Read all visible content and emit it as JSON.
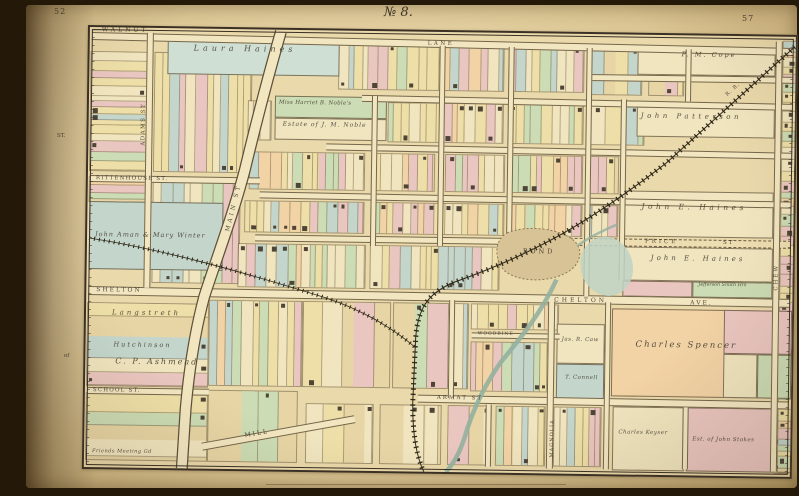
{
  "page": {
    "left_page_number": "52",
    "right_page_number": "57",
    "plate_title": "№ 8.",
    "margin_labels": [
      {
        "id": "margin-st",
        "text": "ST.",
        "x": 31,
        "y": 128
      },
      {
        "id": "margin-of",
        "text": "of",
        "x": 38,
        "y": 348
      }
    ]
  },
  "palette": {
    "paper": "#ead9ab",
    "street": "#f2e6c1",
    "line": "#6b5c41",
    "ink": "#3e362a",
    "pink": "#eac6c0",
    "green": "#ccdcb4",
    "teal": "#c4d6cc",
    "teal2": "#cfdfd4",
    "yellow": "#eedfa8",
    "cream": "#f0e5bf",
    "peach": "#f2d3a6",
    "building": "#4e4537",
    "pond": "#d8c396",
    "marsh": "#bfd3c4",
    "water": "#93b09f",
    "rail": "#2f2818"
  },
  "map": {
    "streets": [
      {
        "id": "walnut-lane-w",
        "band": [
          2,
          5,
          702,
          8
        ],
        "rot": 0.5,
        "labels": [
          {
            "text": "WALNUT",
            "x": 12,
            "y": 0,
            "size": 6,
            "sp": 3
          },
          {
            "text": "LANE",
            "x": 338,
            "y": 10,
            "size": 5.5,
            "sp": 2.5
          }
        ]
      },
      {
        "id": "street-upper-right",
        "band": [
          498,
          40,
          206,
          7
        ],
        "rot": 0,
        "labels": []
      },
      {
        "id": "street-haines-row",
        "band": [
          273,
          64,
          431,
          7
        ],
        "rot": 0.4,
        "labels": []
      },
      {
        "id": "street-mid-row",
        "band": [
          238,
          113,
          466,
          7
        ],
        "rot": 0.35,
        "labels": []
      },
      {
        "id": "rittenhouse-w",
        "band": [
          2,
          148,
          170,
          7
        ],
        "rot": 0,
        "labels": [
          {
            "text": "RITTENHOUSE  ST.",
            "x": 8,
            "y": 149,
            "size": 5.5,
            "sp": 1.2
          }
        ]
      },
      {
        "id": "rittenhouse-e",
        "band": [
          172,
          162,
          532,
          7
        ],
        "rot": 0.3,
        "labels": []
      },
      {
        "id": "street-row5-w",
        "band": [
          168,
          205,
          252,
          7
        ],
        "rot": 0,
        "labels": []
      },
      {
        "id": "price-st",
        "band": [
          418,
          204,
          286,
          8
        ],
        "rot": 0,
        "dashed": true,
        "labels": [
          {
            "text": "PRICE",
            "x": 558,
            "y": 205,
            "size": 5.5,
            "sp": 3
          },
          {
            "text": "ST",
            "x": 636,
            "y": 205,
            "size": 5.5,
            "sp": 2
          }
        ]
      },
      {
        "id": "shelton-chelton-ave",
        "band": [
          2,
          259,
          702,
          9
        ],
        "rot": 0.25,
        "labels": [
          {
            "text": "SHELTON",
            "x": 10,
            "y": 260,
            "size": 6,
            "sp": 2
          },
          {
            "text": "CHELTON",
            "x": 468,
            "y": 264,
            "size": 6,
            "sp": 3
          },
          {
            "text": "AVE.",
            "x": 604,
            "y": 265,
            "size": 6,
            "sp": 2
          }
        ]
      },
      {
        "id": "woodbine-st",
        "band": [
          386,
          300,
          88,
          6
        ],
        "rot": 0,
        "labels": [
          {
            "text": "WOODBINE",
            "x": 392,
            "y": 300,
            "size": 4.5,
            "sp": 1
          }
        ]
      },
      {
        "id": "school-st",
        "band": [
          2,
          360,
          122,
          7
        ],
        "rot": 0,
        "labels": [
          {
            "text": "SCHOOL  ST.",
            "x": 8,
            "y": 361,
            "size": 5.5,
            "sp": 1.2
          }
        ]
      },
      {
        "id": "armat-st",
        "band": [
          333,
          363,
          371,
          8
        ],
        "rot": 0.25,
        "labels": [
          {
            "text": "ARMAT  ST",
            "x": 352,
            "y": 364,
            "size": 5.5,
            "sp": 2
          }
        ]
      },
      {
        "id": "mill-st",
        "band": [
          118,
          414,
          155,
          8
        ],
        "rot": -11,
        "labels": [
          {
            "text": "MILL",
            "x": 160,
            "y": 404,
            "size": 6,
            "sp": 2,
            "rot": -11
          }
        ]
      },
      {
        "id": "adams-st",
        "band": [
          57,
          5,
          7,
          255
        ],
        "vertical": true,
        "labels": [
          {
            "text": "ADAMS  ST",
            "x": 53,
            "y": 118,
            "size": 5.5,
            "sp": 1.5,
            "rot": -90
          }
        ]
      },
      {
        "id": "magnolia-st",
        "band": [
          462,
          268,
          7,
          167
        ],
        "vertical": true,
        "labels": [
          {
            "text": "MAGNOLIA",
            "x": 466,
            "y": 424,
            "size": 5,
            "sp": 1,
            "rot": -90
          }
        ]
      },
      {
        "id": "chew-st",
        "band": [
          686,
          5,
          7,
          430
        ],
        "vertical": true,
        "labels": [
          {
            "text": "CHEW",
            "x": 688,
            "y": 254,
            "size": 5.5,
            "sp": 2,
            "rot": -90
          }
        ]
      },
      {
        "id": "vert-1",
        "band": [
          283,
          65,
          6,
          150
        ],
        "vertical": true,
        "labels": []
      },
      {
        "id": "vert-2",
        "band": [
          350,
          14,
          6,
          200
        ],
        "vertical": true,
        "labels": []
      },
      {
        "id": "vert-3",
        "band": [
          419,
          14,
          6,
          198
        ],
        "vertical": true,
        "labels": []
      },
      {
        "id": "vert-4",
        "band": [
          497,
          14,
          6,
          248
        ],
        "vertical": true,
        "labels": []
      },
      {
        "id": "vert-5",
        "band": [
          532,
          65,
          6,
          181
        ],
        "vertical": true,
        "labels": []
      },
      {
        "id": "vert-6",
        "band": [
          596,
          14,
          6,
          52
        ],
        "vertical": true,
        "labels": []
      },
      {
        "id": "vert-7",
        "band": [
          363,
          268,
          6,
          98
        ],
        "vertical": true,
        "labels": []
      },
      {
        "id": "vert-8",
        "band": [
          519,
          268,
          6,
          167
        ],
        "vertical": true,
        "labels": []
      },
      {
        "id": "vert-9",
        "band": [
          401,
          372,
          6,
          62
        ],
        "vertical": true,
        "labels": []
      },
      {
        "id": "vert-10",
        "band": [
          598,
          372,
          6,
          62
        ],
        "vertical": true,
        "labels": []
      }
    ],
    "feature_labels": [
      {
        "id": "main-st",
        "text": "MAIN  ST",
        "x": 138,
        "y": 202,
        "size": 6,
        "sp": 3,
        "rot": -77
      },
      {
        "id": "pond",
        "text": "POND",
        "x": 436,
        "y": 215,
        "size": 6.5,
        "sp": 3
      },
      {
        "id": "railroad",
        "text": "R. R.",
        "x": 636,
        "y": 58,
        "size": 5,
        "sp": 1,
        "rot": -43
      }
    ],
    "owner_labels": [
      {
        "id": "laura-haines",
        "text": "Laura Haines",
        "x": 104,
        "y": 16,
        "size": 8,
        "sp": 4
      },
      {
        "id": "noble-1",
        "text": "Miss Harriet B. Noble's",
        "x": 190,
        "y": 71,
        "size": 5.5,
        "sp": 0.3
      },
      {
        "id": "noble-2",
        "text": "Estate of J. M. Noble",
        "x": 194,
        "y": 92,
        "size": 6,
        "sp": 1
      },
      {
        "id": "cope",
        "text": "P. M. Cope",
        "x": 592,
        "y": 16,
        "size": 6.5,
        "sp": 2
      },
      {
        "id": "patterson",
        "text": "John Patterson",
        "x": 552,
        "y": 78,
        "size": 7,
        "sp": 3.5
      },
      {
        "id": "john-e-haines-1",
        "text": "John E. Haines",
        "x": 554,
        "y": 168,
        "size": 7.5,
        "sp": 3.5
      },
      {
        "id": "john-e-haines-2",
        "text": "John E. Haines",
        "x": 564,
        "y": 220,
        "size": 7,
        "sp": 3
      },
      {
        "id": "jefferson-smith",
        "text": "Jefferson Smith Hrs",
        "x": 612,
        "y": 248,
        "size": 4.8,
        "sp": 0
      },
      {
        "id": "charles-spencer",
        "text": "Charles Spencer",
        "x": 550,
        "y": 306,
        "size": 8.5,
        "sp": 2
      },
      {
        "id": "jas-caw",
        "text": "Jas. R. Caw",
        "x": 476,
        "y": 304,
        "size": 5.5,
        "sp": 0.5
      },
      {
        "id": "t-connell",
        "text": "T. Connell",
        "x": 480,
        "y": 342,
        "size": 5.5,
        "sp": 0.5
      },
      {
        "id": "langstreth",
        "text": "Langstreth",
        "x": 26,
        "y": 282,
        "size": 7,
        "sp": 3
      },
      {
        "id": "hutchinson",
        "text": "Hutchinson",
        "x": 28,
        "y": 314,
        "size": 6.5,
        "sp": 2
      },
      {
        "id": "ashmead",
        "text": "C. P. Ashmead",
        "x": 30,
        "y": 330,
        "size": 8,
        "sp": 2
      },
      {
        "id": "aman-winter",
        "text": "John Aman & Mary Winter",
        "x": 8,
        "y": 204,
        "size": 6.5,
        "sp": 1
      },
      {
        "id": "charles-keyser",
        "text": "Charles Keyser",
        "x": 534,
        "y": 396,
        "size": 5.5,
        "sp": 0.5
      },
      {
        "id": "john-stokes",
        "text": "Est. of John Stokes",
        "x": 608,
        "y": 402,
        "size": 5.5,
        "sp": 0.5
      },
      {
        "id": "friends-meeting",
        "text": "Friends Meeting Gd",
        "x": 8,
        "y": 422,
        "size": 5,
        "sp": 0.5
      }
    ],
    "named_parcels": [
      {
        "id": "parcel-laura-haines",
        "rect": [
          78,
          10,
          172,
          36
        ],
        "color": "teal2"
      },
      {
        "id": "parcel-noble-green",
        "rect": [
          186,
          66,
          112,
          22
        ],
        "color": "green"
      },
      {
        "id": "parcel-noble-cream",
        "rect": [
          186,
          88,
          112,
          22
        ],
        "color": "cream"
      },
      {
        "id": "parcel-cope",
        "rect": [
          548,
          12,
          138,
          28
        ],
        "color": "cream"
      },
      {
        "id": "parcel-patterson",
        "rect": [
          548,
          72,
          138,
          30
        ],
        "color": "cream"
      },
      {
        "id": "parcel-haines-a",
        "rect": [
          536,
          156,
          150,
          46
        ],
        "color": "cream"
      },
      {
        "id": "parcel-haines-b",
        "rect": [
          536,
          212,
          150,
          34
        ],
        "color": "cream"
      },
      {
        "id": "parcel-smith-pink",
        "rect": [
          536,
          246,
          70,
          16
        ],
        "color": "pink"
      },
      {
        "id": "parcel-smith-green",
        "rect": [
          606,
          246,
          80,
          16
        ],
        "color": "green"
      },
      {
        "id": "parcel-aman-winter",
        "rect": [
          2,
          174,
          134,
          68
        ],
        "color": "teal"
      },
      {
        "id": "parcel-spencer",
        "rect": [
          526,
          274,
          180,
          88
        ],
        "color": "peach"
      },
      {
        "id": "parcel-spencer-pink",
        "rect": [
          638,
          274,
          68,
          44
        ],
        "color": "pink"
      },
      {
        "id": "parcel-spencer-cream",
        "rect": [
          638,
          318,
          34,
          44
        ],
        "color": "cream"
      },
      {
        "id": "parcel-spencer-green",
        "rect": [
          672,
          318,
          34,
          44
        ],
        "color": "green"
      },
      {
        "id": "parcel-keyser",
        "rect": [
          528,
          372,
          72,
          64
        ],
        "color": "cream"
      },
      {
        "id": "parcel-stokes",
        "rect": [
          602,
          372,
          88,
          64
        ],
        "color": "pink"
      },
      {
        "id": "parcel-caw",
        "rect": [
          471,
          290,
          48,
          40
        ],
        "color": "cream"
      },
      {
        "id": "parcel-connell",
        "rect": [
          471,
          330,
          48,
          40
        ],
        "color": "teal"
      }
    ],
    "blocks": [
      {
        "rect": [
          2,
          25,
          55,
          118
        ],
        "dir": "h",
        "density": "dense"
      },
      {
        "rect": [
          2,
          150,
          55,
          24
        ],
        "dir": "h",
        "density": "dense"
      },
      {
        "rect": [
          2,
          276,
          120,
          82
        ],
        "dir": "h",
        "density": "sparse"
      },
      {
        "rect": [
          2,
          366,
          120,
          66
        ],
        "dir": "h",
        "density": "sparse"
      },
      {
        "rect": [
          66,
          25,
          96,
          118
        ],
        "dir": "v",
        "density": "dense"
      },
      {
        "rect": [
          66,
          150,
          86,
          104
        ],
        "dir": "v",
        "density": "dense"
      },
      {
        "rect": [
          124,
          272,
          92,
          84
        ],
        "dir": "v",
        "density": "dense"
      },
      {
        "rect": [
          250,
          14,
          164,
          44
        ],
        "dir": "v",
        "density": "dense"
      },
      {
        "rect": [
          420,
          14,
          74,
          44
        ],
        "dir": "v",
        "density": "dense"
      },
      {
        "rect": [
          500,
          14,
          52,
          46
        ],
        "dir": "v",
        "density": "sparse"
      },
      {
        "rect": [
          560,
          14,
          34,
          46
        ],
        "dir": "v",
        "density": "sparse"
      },
      {
        "rect": [
          160,
          72,
          22,
          38
        ],
        "dir": "v",
        "density": "dense"
      },
      {
        "rect": [
          300,
          72,
          114,
          38
        ],
        "dir": "v",
        "density": "dense"
      },
      {
        "rect": [
          420,
          72,
          74,
          38
        ],
        "dir": "v",
        "density": "dense"
      },
      {
        "rect": [
          500,
          72,
          55,
          38
        ],
        "dir": "v",
        "density": "sparse"
      },
      {
        "rect": [
          162,
          123,
          114,
          36
        ],
        "dir": "v",
        "density": "dense"
      },
      {
        "rect": [
          284,
          123,
          62,
          36
        ],
        "dir": "v",
        "density": "dense"
      },
      {
        "rect": [
          358,
          123,
          58,
          36
        ],
        "dir": "v",
        "density": "dense"
      },
      {
        "rect": [
          424,
          123,
          70,
          36
        ],
        "dir": "v",
        "density": "dense"
      },
      {
        "rect": [
          500,
          123,
          30,
          36
        ],
        "dir": "v",
        "density": "dense"
      },
      {
        "rect": [
          158,
          172,
          118,
          30
        ],
        "dir": "v",
        "density": "dense"
      },
      {
        "rect": [
          284,
          172,
          132,
          30
        ],
        "dir": "v",
        "density": "dense"
      },
      {
        "rect": [
          424,
          172,
          70,
          30
        ],
        "dir": "v",
        "density": "dense"
      },
      {
        "rect": [
          500,
          172,
          30,
          30
        ],
        "dir": "v",
        "density": "dense"
      },
      {
        "rect": [
          152,
          215,
          126,
          42
        ],
        "dir": "v",
        "density": "dense"
      },
      {
        "rect": [
          284,
          215,
          128,
          42
        ],
        "dir": "v",
        "density": "dense"
      },
      {
        "rect": [
          218,
          272,
          86,
          84
        ],
        "dir": "v",
        "density": "sparse"
      },
      {
        "rect": [
          308,
          272,
          74,
          84
        ],
        "dir": "v",
        "density": "sparse"
      },
      {
        "rect": [
          386,
          272,
          86,
          24
        ],
        "dir": "v",
        "density": "dense"
      },
      {
        "rect": [
          386,
          310,
          82,
          48
        ],
        "dir": "v",
        "density": "dense"
      },
      {
        "rect": [
          124,
          362,
          88,
          70
        ],
        "dir": "v",
        "density": "sparse"
      },
      {
        "rect": [
          222,
          374,
          66,
          58
        ],
        "dir": "v",
        "density": "sparse"
      },
      {
        "rect": [
          296,
          374,
          60,
          58
        ],
        "dir": "v",
        "density": "sparse"
      },
      {
        "rect": [
          364,
          374,
          42,
          58
        ],
        "dir": "v",
        "density": "sparse"
      },
      {
        "rect": [
          412,
          374,
          48,
          58
        ],
        "dir": "v",
        "density": "dense"
      },
      {
        "rect": [
          470,
          374,
          46,
          58
        ],
        "dir": "v",
        "density": "dense"
      },
      {
        "rect": [
          691,
          372,
          13,
          64
        ],
        "dir": "h",
        "density": "dense"
      },
      {
        "rect": [
          694,
          5,
          12,
          430
        ],
        "dir": "h",
        "density": "dense"
      }
    ]
  }
}
